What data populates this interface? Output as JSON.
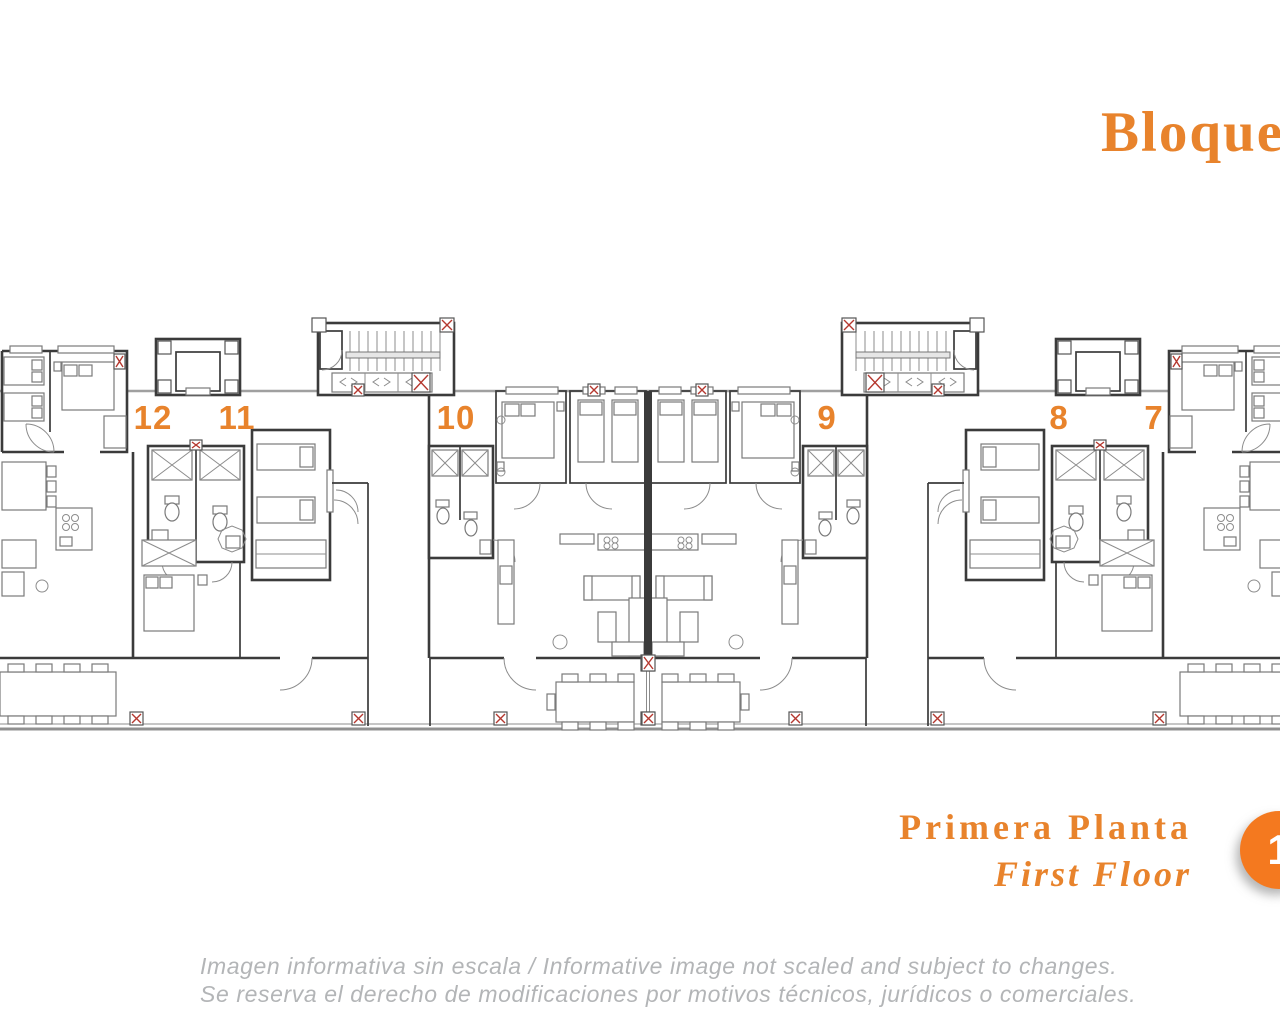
{
  "title": {
    "text": "Bloque",
    "color": "#e8832c"
  },
  "plan": {
    "units": [
      {
        "label": "12"
      },
      {
        "label": "11"
      },
      {
        "label": "10"
      },
      {
        "label": "9"
      },
      {
        "label": "8"
      },
      {
        "label": "7"
      }
    ],
    "label_color": "#e8832c",
    "wall_color": "#3b3b3b",
    "facade_line_color": "#a0a0a0",
    "accent_color": "#b5382f"
  },
  "floor_label": {
    "primary": "Primera Planta",
    "secondary": "First Floor",
    "color": "#e8832c",
    "badge": {
      "number": "1",
      "background": "#f4791f",
      "text_color": "#ffffff"
    }
  },
  "disclaimer": {
    "line1": "Imagen informativa sin escala /  Informative image not scaled and subject to changes.",
    "line2": "Se reserva el derecho de modificaciones por motivos técnicos, jurídicos o comerciales.",
    "color": "#b3b5b7"
  }
}
